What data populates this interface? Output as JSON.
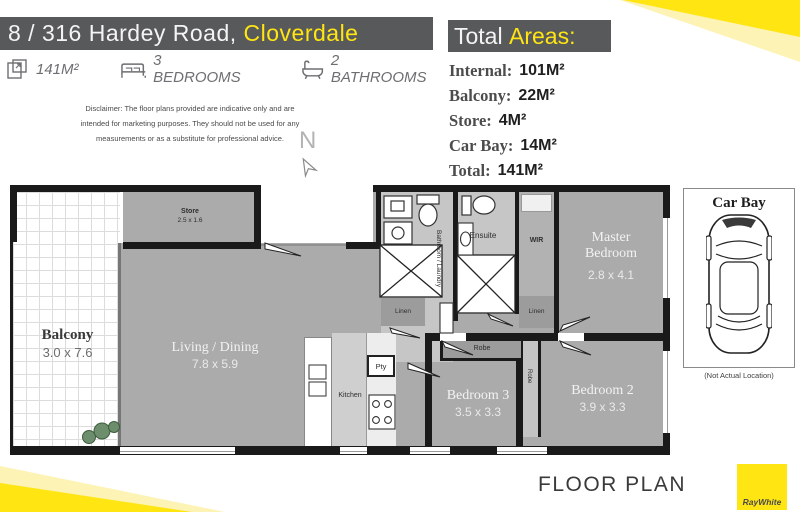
{
  "header": {
    "address": "8 / 316 Hardey Road, ",
    "suburb": "Cloverdale"
  },
  "features": [
    {
      "icon": "area-icon",
      "label": "141M²"
    },
    {
      "icon": "bed-icon",
      "label": "3 BEDROOMS"
    },
    {
      "icon": "bath-icon",
      "label": "2 BATHROOMS"
    }
  ],
  "disclaimer": {
    "line1": "Disclaimer: The floor plans provided are indicative only and are",
    "line2": "intended for marketing purposes. They should not be used for any",
    "line3": "measurements or as a substitute for professional advice."
  },
  "compass": {
    "label": "N"
  },
  "areas": {
    "title_white": "Total ",
    "title_yellow": "Areas:",
    "rows": [
      {
        "label": "Internal:",
        "value": "101M²"
      },
      {
        "label": "Balcony:",
        "value": "22M²"
      },
      {
        "label": "Store:",
        "value": "4M²"
      },
      {
        "label": "Car Bay:",
        "value": "14M²"
      },
      {
        "label": "Total:",
        "value": "141M²"
      }
    ]
  },
  "floor_plan": {
    "rooms": {
      "balcony": {
        "name": "Balcony",
        "dims": "3.0 x 7.6"
      },
      "store": {
        "name": "Store",
        "dims": "2.5 x 1.6"
      },
      "living": {
        "name": "Living / Dining",
        "dims": "7.8 x 5.9"
      },
      "kitchen": {
        "name": "Kitchen"
      },
      "pantry": {
        "name": "Pty"
      },
      "bathroom": {
        "name": "Bathroom / Laundry"
      },
      "linen_bath": {
        "name": "Linen"
      },
      "ensuite": {
        "name": "Ensuite"
      },
      "wir": {
        "name": "WIR"
      },
      "linen_wir": {
        "name": "Linen"
      },
      "master": {
        "name": "Master Bedroom",
        "dims": "2.8 x 4.1"
      },
      "bed3": {
        "name": "Bedroom 3",
        "dims": "3.5 x 3.3"
      },
      "robe3": {
        "name": "Robe"
      },
      "bed2": {
        "name": "Bedroom 2",
        "dims": "3.9 x 3.3"
      },
      "robe2": {
        "name": "Robe"
      }
    },
    "caption": "FLOOR PLAN"
  },
  "car_bay": {
    "title": "Car Bay",
    "note": "(Not Actual Location)"
  },
  "brand": {
    "logo_text": "RayWhite"
  },
  "colors": {
    "accent_yellow": "#ffe512",
    "pale_yellow": "#fcf3b5",
    "header_gray": "#58595b",
    "room_gray": "#ababab",
    "wall_black": "#1a1a1a"
  }
}
